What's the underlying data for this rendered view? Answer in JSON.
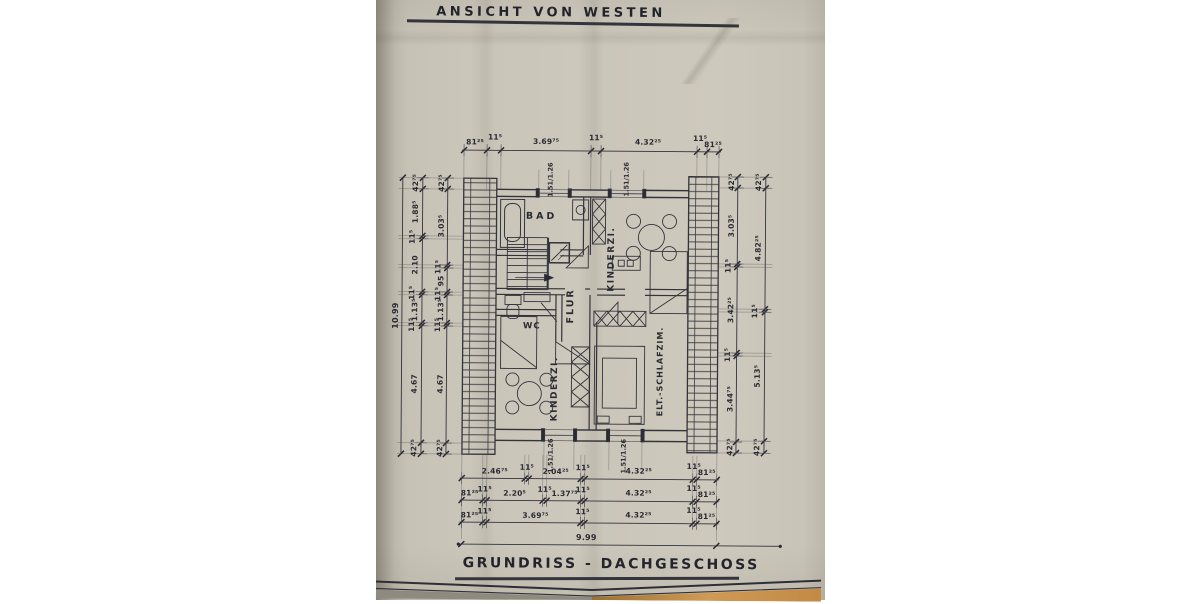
{
  "titles": {
    "top": "ANSICHT VON WESTEN",
    "bottom": "GRUNDRISS - DACHGESCHOSS"
  },
  "rooms": {
    "bad": "BAD",
    "kinderzimmer_top": "KINDERZI.",
    "flur": "FLUR",
    "wc": "WC",
    "kinderzimmer_bottom": "KINDERZI.",
    "eltern_schlafzimmer": "ELT.-SCHLAFZIM."
  },
  "dims": {
    "overall_height": "10.99",
    "overall_width": "9.99",
    "window_size": "1.51/1.26",
    "top_chain": [
      "81²⁵",
      "11⁵",
      "3.69⁷⁵",
      "11⁵",
      "4.32²⁵",
      "11⁵",
      "81²⁵"
    ],
    "left_outer_chain": [
      "42⁷⁵",
      "1.88⁵",
      "11⁵",
      "2.10",
      "11⁵",
      "1.13⁵",
      "11⁵",
      "4.67",
      "42⁷⁵"
    ],
    "left_inner_chain": [
      "42⁷⁵",
      "3.03⁵",
      "11⁵",
      "95",
      "11⁵",
      "1.13⁵",
      "11⁵",
      "4.67",
      "42⁷⁵"
    ],
    "right_inner_chain": [
      "42⁷⁵",
      "3.03⁵",
      "11⁵",
      "3.42²⁵",
      "11⁵",
      "3.44⁷⁵",
      "42⁷⁵"
    ],
    "right_outer_chain": [
      "42⁷⁵",
      "4.82²⁵",
      "11⁵",
      "5.13⁵",
      "42⁷⁵"
    ],
    "bottom_chain_1": [
      "2.46⁷⁵",
      "11⁵",
      "2.04²⁵",
      "11⁵",
      "4.32²⁵",
      "11⁵",
      "81²⁵"
    ],
    "bottom_chain_2": [
      "81²⁵",
      "11⁵",
      "2.20⁵",
      "11⁵",
      "1.37⁷⁵",
      "11⁵",
      "4.32²⁵",
      "11⁵",
      "81²⁵"
    ],
    "bottom_chain_3": [
      "81²⁵",
      "11⁵",
      "3.69⁷⁵",
      "11⁵",
      "4.32²⁵",
      "11⁵",
      "81²⁵"
    ]
  },
  "colors": {
    "paper": "#cbc6ba",
    "ink": "#2a2a32",
    "wood": "#c28a44"
  }
}
